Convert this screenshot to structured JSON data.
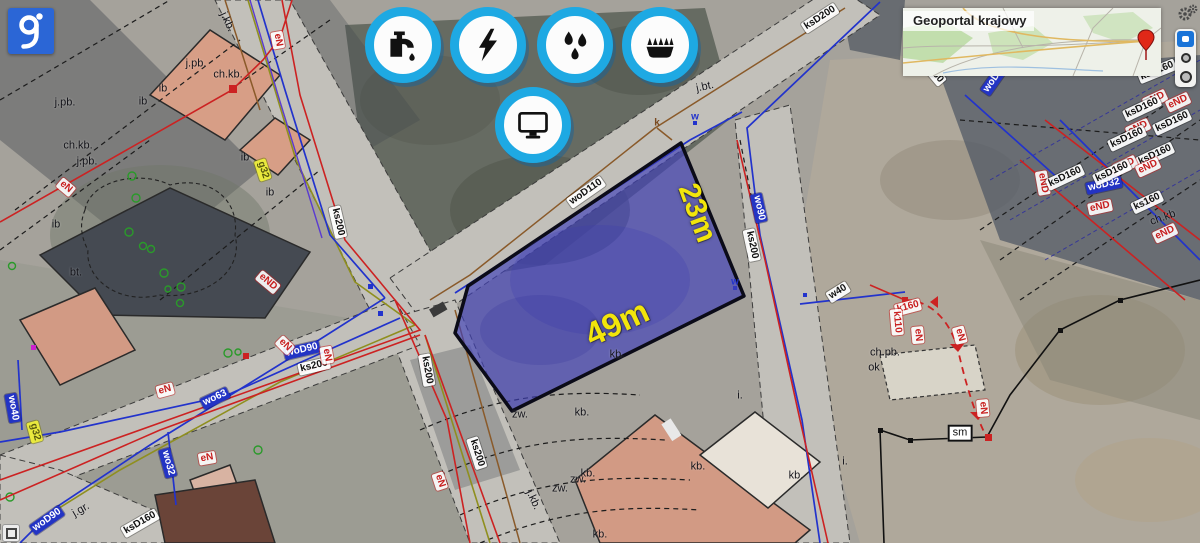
{
  "app": {
    "type": "geoportal-map-viewer"
  },
  "logo": {
    "letter": "g"
  },
  "minimap": {
    "title": "Geoportal krajowy"
  },
  "toolbar": {
    "icons": [
      {
        "name": "water-supply"
      },
      {
        "name": "electricity"
      },
      {
        "name": "sewage-drops"
      },
      {
        "name": "gas"
      },
      {
        "name": "monitor"
      }
    ]
  },
  "parcel": {
    "dim_long": "49m",
    "dim_short": "23m"
  },
  "colors": {
    "icon_ring_cyan": "#1ea9e3",
    "parcel_fill": "#4040b9",
    "dimension_yellow": "#f2e50b",
    "label_red": "#c81e1e",
    "label_blue": "#2334c4",
    "logo_blue": "#2b66d6"
  },
  "map_labels": [
    {
      "t": "woD110",
      "x": 586,
      "y": 192,
      "r": -35,
      "s": "wb"
    },
    {
      "t": "ksD200",
      "x": 820,
      "y": 18,
      "r": -33,
      "s": "wb"
    },
    {
      "t": "ks200",
      "x": 338,
      "y": 222,
      "r": 77,
      "s": "wb"
    },
    {
      "t": "woD90",
      "x": 302,
      "y": 350,
      "r": -13,
      "s": "bb"
    },
    {
      "t": "ks200",
      "x": 314,
      "y": 366,
      "r": -13,
      "s": "wb"
    },
    {
      "t": "ks200",
      "x": 427,
      "y": 370,
      "r": 80,
      "s": "wb"
    },
    {
      "t": "ks200",
      "x": 477,
      "y": 453,
      "r": 72,
      "s": "wb"
    },
    {
      "t": "eN",
      "x": 440,
      "y": 481,
      "r": 72,
      "s": "rb"
    },
    {
      "t": "wo90",
      "x": 759,
      "y": 208,
      "r": 78,
      "s": "bb"
    },
    {
      "t": "ks200",
      "x": 752,
      "y": 245,
      "r": 78,
      "s": "wb"
    },
    {
      "t": "w40",
      "x": 838,
      "y": 292,
      "r": -32,
      "s": "wb"
    },
    {
      "t": "sm",
      "x": 960,
      "y": 433,
      "r": 0,
      "s": "smb"
    },
    {
      "t": "ksD160",
      "x": 140,
      "y": 523,
      "r": -30,
      "s": "wb"
    },
    {
      "t": "woD90",
      "x": 47,
      "y": 520,
      "r": -35,
      "s": "bb"
    },
    {
      "t": "j.gr.",
      "x": 81,
      "y": 510,
      "r": -30,
      "s": "pl"
    },
    {
      "t": "wo63",
      "x": 215,
      "y": 398,
      "r": -25,
      "s": "bb"
    },
    {
      "t": "eN",
      "x": 165,
      "y": 390,
      "r": -15,
      "s": "rb"
    },
    {
      "t": "wo40",
      "x": 13,
      "y": 408,
      "r": 80,
      "s": "bb"
    },
    {
      "t": "wo32",
      "x": 168,
      "y": 463,
      "r": 75,
      "s": "bb"
    },
    {
      "t": "eN",
      "x": 207,
      "y": 458,
      "r": -10,
      "s": "rb"
    },
    {
      "t": "eN",
      "x": 285,
      "y": 345,
      "r": 45,
      "s": "rb"
    },
    {
      "t": "eN",
      "x": 327,
      "y": 355,
      "r": 80,
      "s": "rb"
    },
    {
      "t": "eND",
      "x": 268,
      "y": 282,
      "r": 40,
      "s": "rb"
    },
    {
      "t": "eN",
      "x": 66,
      "y": 187,
      "r": 40,
      "s": "rb"
    },
    {
      "t": "eN",
      "x": 278,
      "y": 40,
      "r": 80,
      "s": "rb"
    },
    {
      "t": "j.kb.",
      "x": 227,
      "y": 22,
      "r": 65,
      "s": "pl"
    },
    {
      "t": "j.pb.",
      "x": 196,
      "y": 64,
      "r": 0,
      "s": "pl"
    },
    {
      "t": "ch.kb.",
      "x": 228,
      "y": 75,
      "r": 0,
      "s": "pl"
    },
    {
      "t": "j.pb.",
      "x": 65,
      "y": 103,
      "r": 0,
      "s": "pl"
    },
    {
      "t": "ch.kb.",
      "x": 78,
      "y": 146,
      "r": 0,
      "s": "pl"
    },
    {
      "t": "j.pb.",
      "x": 87,
      "y": 162,
      "r": 0,
      "s": "pl"
    },
    {
      "t": "ib",
      "x": 163,
      "y": 89,
      "r": 0,
      "s": "pl"
    },
    {
      "t": "ib",
      "x": 143,
      "y": 102,
      "r": 0,
      "s": "pl"
    },
    {
      "t": "ib",
      "x": 245,
      "y": 158,
      "r": 0,
      "s": "pl"
    },
    {
      "t": "ib",
      "x": 270,
      "y": 193,
      "r": 0,
      "s": "pl"
    },
    {
      "t": "ib",
      "x": 56,
      "y": 225,
      "r": 0,
      "s": "pl"
    },
    {
      "t": "bt.",
      "x": 76,
      "y": 273,
      "r": 0,
      "s": "pl"
    },
    {
      "t": "g32",
      "x": 263,
      "y": 170,
      "r": 72,
      "s": "yb"
    },
    {
      "t": "g32",
      "x": 35,
      "y": 432,
      "r": 75,
      "s": "yb"
    },
    {
      "t": "j.bt.",
      "x": 705,
      "y": 87,
      "r": -12,
      "s": "pl"
    },
    {
      "t": "k",
      "x": 657,
      "y": 123,
      "r": 0,
      "s": "plk"
    },
    {
      "t": "w",
      "x": 695,
      "y": 117,
      "r": 0,
      "s": "plb"
    },
    {
      "t": "w",
      "x": 735,
      "y": 282,
      "r": 0,
      "s": "plb"
    },
    {
      "t": "ch.pb.",
      "x": 885,
      "y": 353,
      "r": 0,
      "s": "pl"
    },
    {
      "t": "ok",
      "x": 874,
      "y": 368,
      "r": 0,
      "s": "pl"
    },
    {
      "t": "kb.",
      "x": 617,
      "y": 355,
      "r": 0,
      "s": "pl"
    },
    {
      "t": "kb.",
      "x": 582,
      "y": 413,
      "r": 0,
      "s": "pl"
    },
    {
      "t": "zw.",
      "x": 520,
      "y": 415,
      "r": 0,
      "s": "pl"
    },
    {
      "t": "kb.",
      "x": 588,
      "y": 474,
      "r": 0,
      "s": "pl"
    },
    {
      "t": "zw.",
      "x": 578,
      "y": 480,
      "r": 0,
      "s": "pl"
    },
    {
      "t": "zw.",
      "x": 560,
      "y": 489,
      "r": 0,
      "s": "pl"
    },
    {
      "t": "j.kb.",
      "x": 533,
      "y": 500,
      "r": 65,
      "s": "pl"
    },
    {
      "t": "kb.",
      "x": 600,
      "y": 535,
      "r": 0,
      "s": "pl"
    },
    {
      "t": "kb.",
      "x": 698,
      "y": 467,
      "r": 0,
      "s": "pl"
    },
    {
      "t": "kb.",
      "x": 796,
      "y": 476,
      "r": 0,
      "s": "pl"
    },
    {
      "t": "i.",
      "x": 845,
      "y": 462,
      "r": 0,
      "s": "pl"
    },
    {
      "t": "i.",
      "x": 740,
      "y": 396,
      "r": 0,
      "s": "pl"
    },
    {
      "t": "k160",
      "x": 908,
      "y": 307,
      "r": -15,
      "s": "rb"
    },
    {
      "t": "k110",
      "x": 897,
      "y": 322,
      "r": 85,
      "s": "rb"
    },
    {
      "t": "eN",
      "x": 918,
      "y": 335,
      "r": 85,
      "s": "rb"
    },
    {
      "t": "eN",
      "x": 960,
      "y": 335,
      "r": 75,
      "s": "rb"
    },
    {
      "t": "eN",
      "x": 983,
      "y": 408,
      "r": 85,
      "s": "rb"
    },
    {
      "t": "ksD160",
      "x": 930,
      "y": 68,
      "r": 50,
      "s": "wb"
    },
    {
      "t": "woD32",
      "x": 995,
      "y": 78,
      "r": -55,
      "s": "bb"
    },
    {
      "t": "eND",
      "x": 1043,
      "y": 183,
      "r": 80,
      "s": "rb"
    },
    {
      "t": "ksD160",
      "x": 1065,
      "y": 177,
      "r": -25,
      "s": "wb"
    },
    {
      "t": "woD32",
      "x": 1104,
      "y": 185,
      "r": -12,
      "s": "bb"
    },
    {
      "t": "ksD160",
      "x": 1157,
      "y": 71,
      "r": -22,
      "s": "wb"
    },
    {
      "t": "eND",
      "x": 1155,
      "y": 99,
      "r": -25,
      "s": "rb"
    },
    {
      "t": "eND",
      "x": 1178,
      "y": 102,
      "r": -25,
      "s": "rb"
    },
    {
      "t": "ksD160",
      "x": 1142,
      "y": 108,
      "r": -25,
      "s": "wb"
    },
    {
      "t": "ksD160",
      "x": 1172,
      "y": 122,
      "r": -25,
      "s": "wb"
    },
    {
      "t": "eND",
      "x": 1138,
      "y": 128,
      "r": -25,
      "s": "rb"
    },
    {
      "t": "ksD160",
      "x": 1127,
      "y": 138,
      "r": -25,
      "s": "wb"
    },
    {
      "t": "ksD160",
      "x": 1155,
      "y": 155,
      "r": -25,
      "s": "wb"
    },
    {
      "t": "eND",
      "x": 1125,
      "y": 165,
      "r": -25,
      "s": "rb"
    },
    {
      "t": "eND",
      "x": 1148,
      "y": 167,
      "r": -25,
      "s": "rb"
    },
    {
      "t": "ksD160",
      "x": 1112,
      "y": 172,
      "r": -25,
      "s": "wb"
    },
    {
      "t": "ks160",
      "x": 1147,
      "y": 202,
      "r": -25,
      "s": "wb"
    },
    {
      "t": "eND",
      "x": 1100,
      "y": 207,
      "r": -12,
      "s": "rb"
    },
    {
      "t": "ch.kb",
      "x": 1163,
      "y": 218,
      "r": -20,
      "s": "pl"
    },
    {
      "t": "eND",
      "x": 1165,
      "y": 233,
      "r": -25,
      "s": "rb"
    }
  ]
}
